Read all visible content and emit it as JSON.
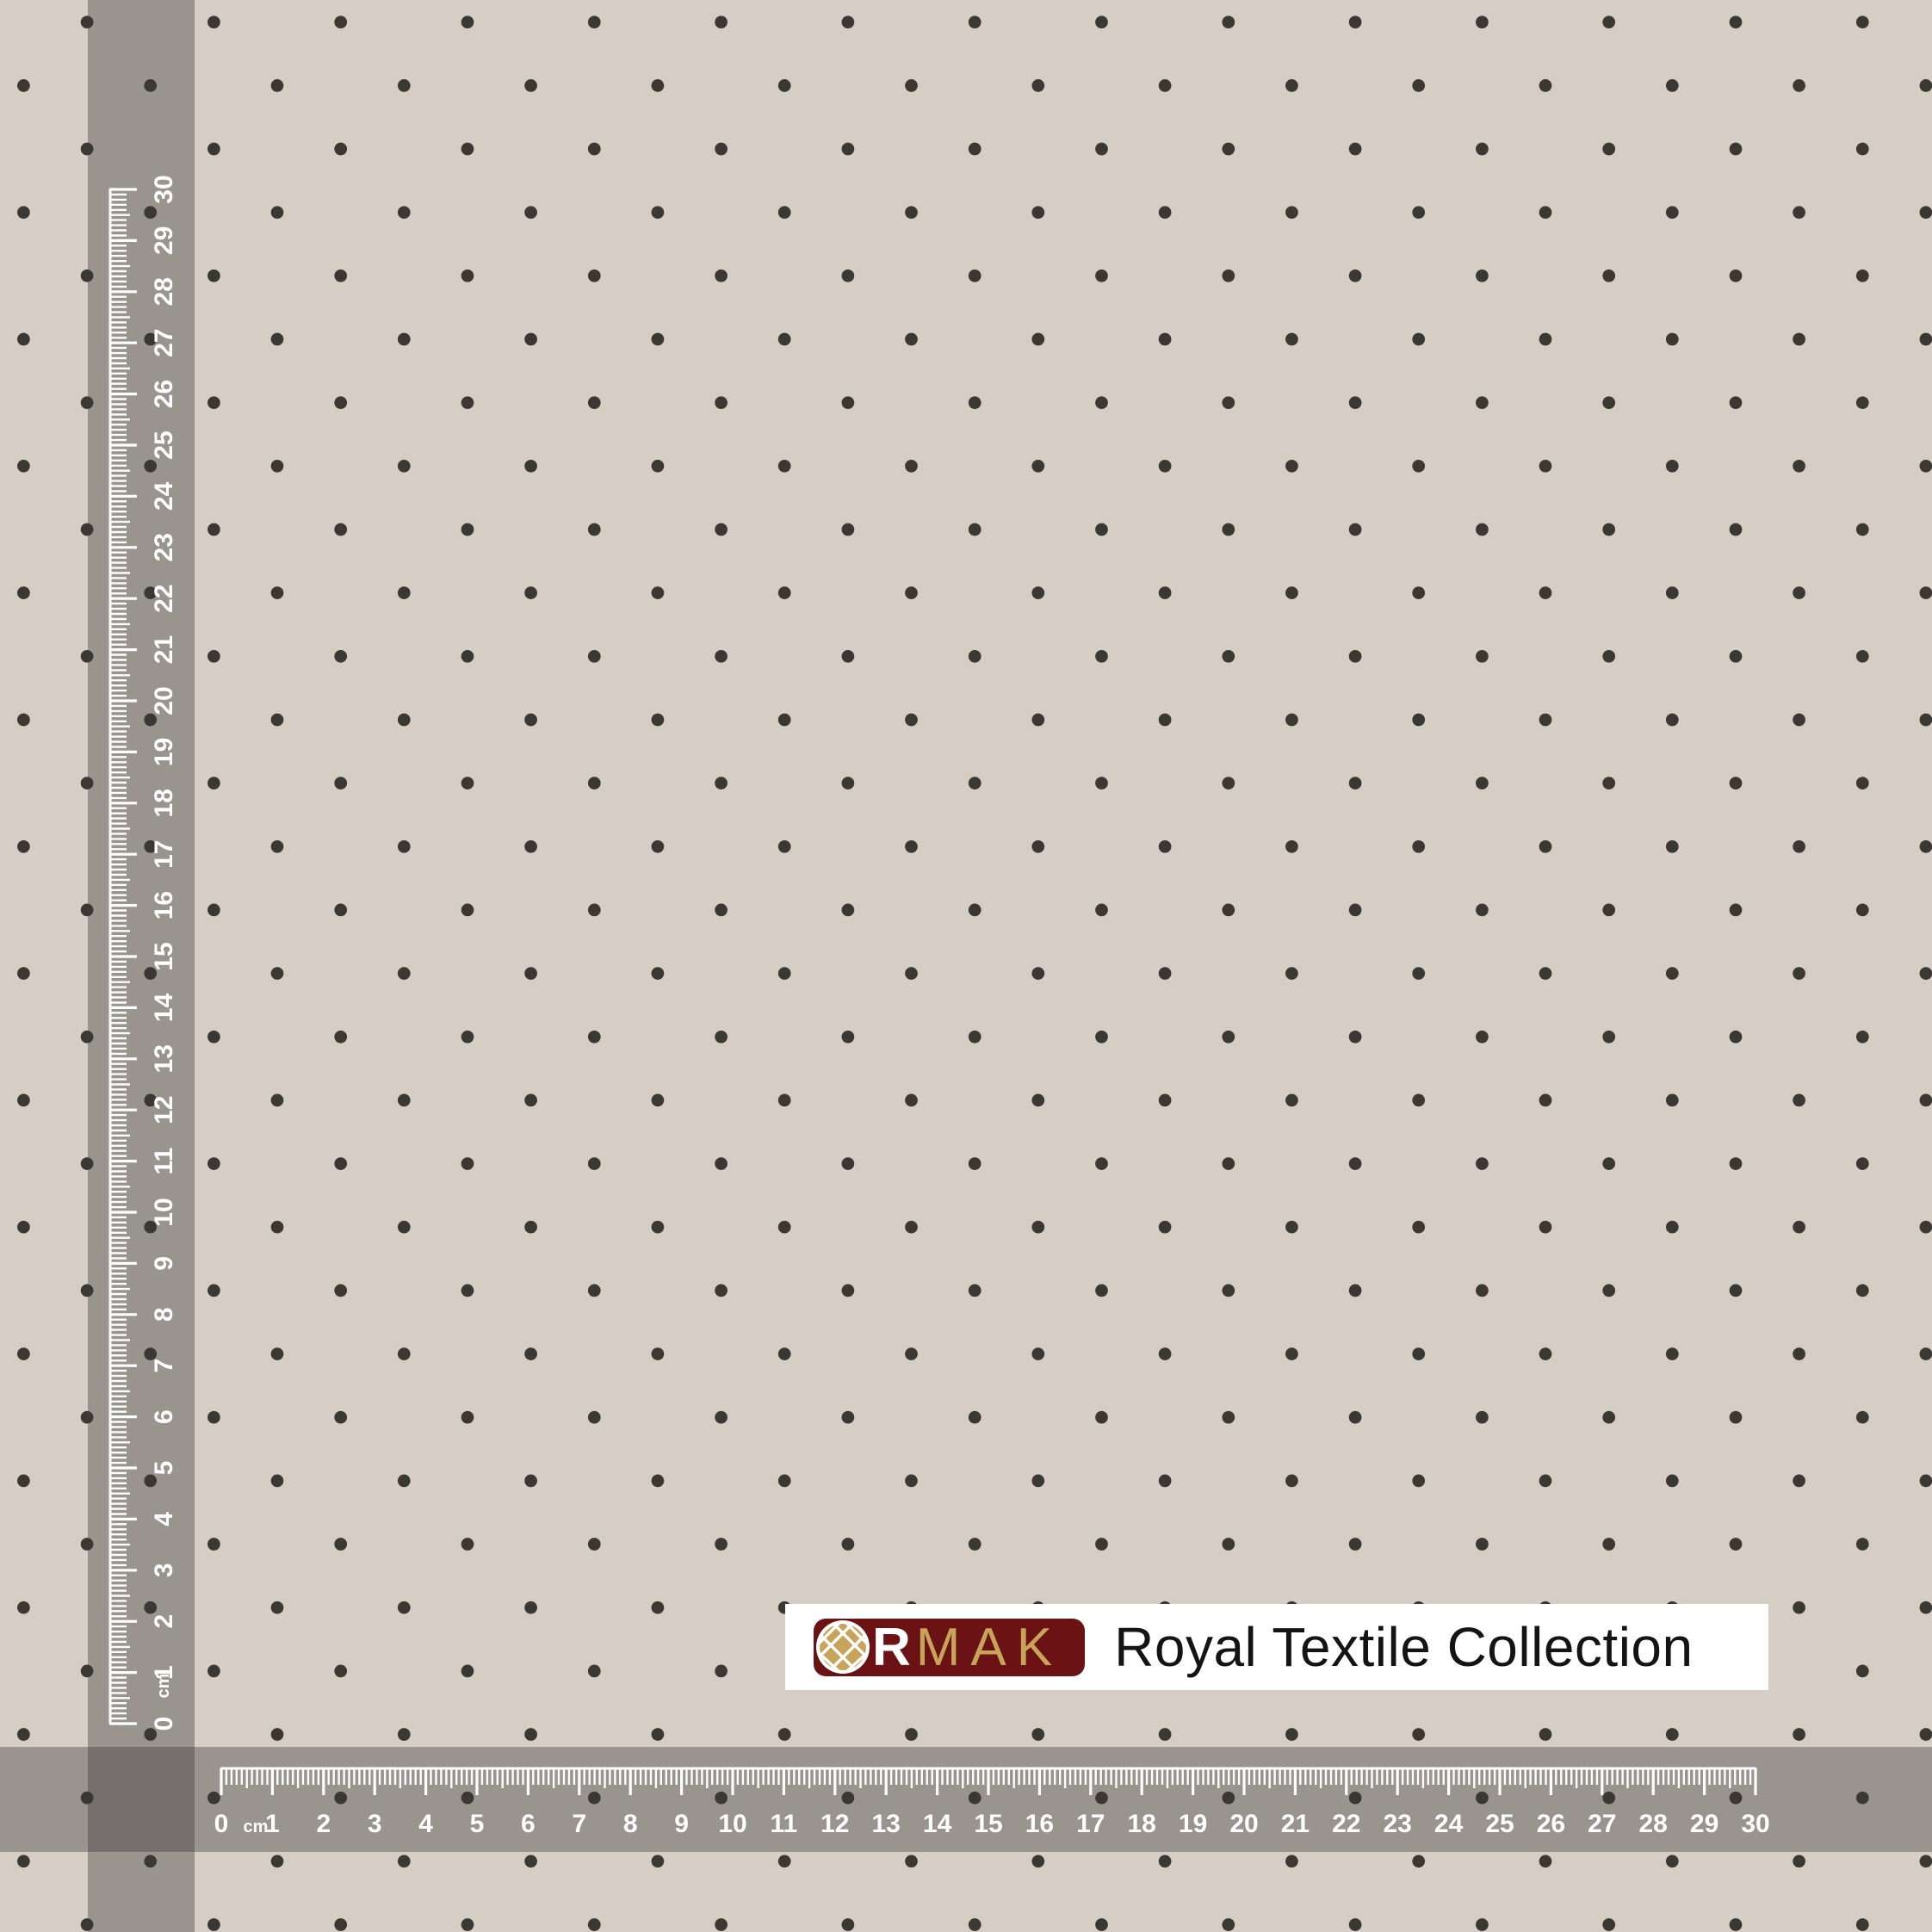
{
  "colors": {
    "background": "#d6cec5",
    "dot": "#3b3733",
    "band_overlay": "#3a3836",
    "band_opacity": 0.38,
    "ruler_marks": "#ffffff",
    "logo_box_bg": "#ffffff",
    "logo_mark_bg": "#6a1214",
    "logo_gold": "#c8a35a",
    "tagline_color": "#141414"
  },
  "pattern": {
    "dot_radius": 7.35
  },
  "rulers": {
    "unit": "cm",
    "min": 0,
    "max": 30,
    "labels": [
      "0",
      "1",
      "2",
      "3",
      "4",
      "5",
      "6",
      "7",
      "8",
      "9",
      "10",
      "11",
      "12",
      "13",
      "14",
      "15",
      "16",
      "17",
      "18",
      "19",
      "20",
      "21",
      "22",
      "23",
      "24",
      "25",
      "26",
      "27",
      "28",
      "29",
      "30"
    ]
  },
  "logo": {
    "letter_r": "R",
    "letters_mak": "MAK",
    "tagline": "Royal Textile Collection"
  }
}
